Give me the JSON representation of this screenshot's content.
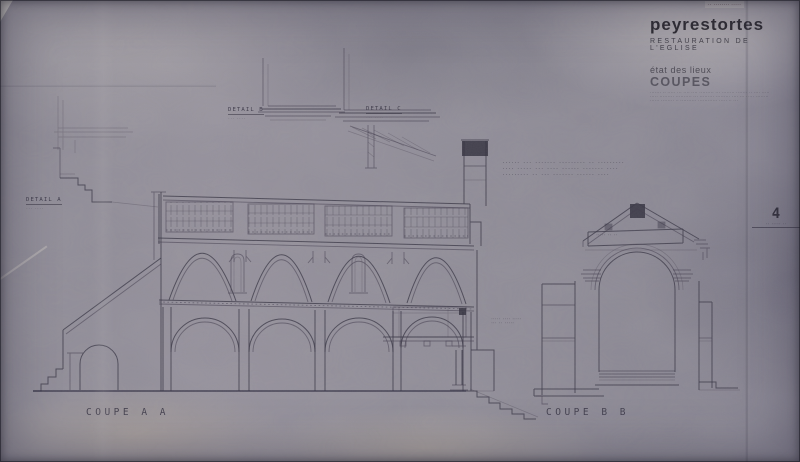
{
  "sheet": {
    "stamp": {
      "text": "·· ········ ·····"
    },
    "title_block": {
      "title": "peyrestortes",
      "subtitle": "RESTAURATION  DE  L'EGLISE",
      "series": "état des lieux",
      "sheet_name": "COUPES",
      "fine_print": [
        "······· ·· ····· ··· ···· ···· ········· ··· ········ ······· ·· ···· ·····",
        "····· ········· ·········· ··· ········· ········· ···· ··· ····· ········",
        "······ ········ ·· ·········· ············ ····· ·· ···"
      ],
      "sheet_number": "4",
      "sheet_number_caption": "·· ····· ··"
    },
    "labels": {
      "detail_a": "DETAIL  A",
      "detail_a_sub": "··· ····",
      "detail_b": "DETAIL  B",
      "detail_b_sub": "··· ····",
      "detail_c": "DETAIL  C",
      "detail_c_sub": "··· ····",
      "coupe_aa": "COUPE  A A",
      "coupe_bb": "COUPE  B B"
    },
    "annotations": {
      "note_line1": "······ ··· ······· ········· ·· ·········",
      "note_line2": "···· ····· ··· ···· ······ ······· ····",
      "note_line3": "········· ·· ··· ······· ······ ····",
      "tribune_note1": "····· ···· ·····",
      "tribune_note2": "··· ·· ·····",
      "band_note": "····· ·· ··"
    },
    "colors": {
      "paper": "#908d97",
      "ink": "#3b3847",
      "title_ink": "#26242c"
    }
  }
}
